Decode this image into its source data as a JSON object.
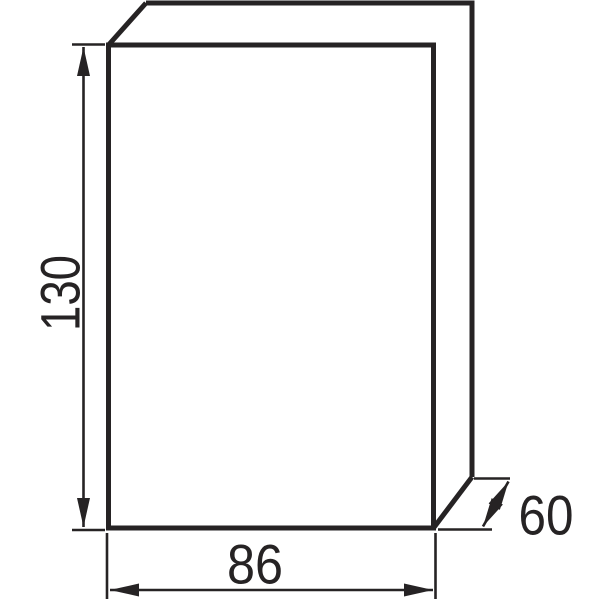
{
  "page": {
    "background_color": "#ffffff"
  },
  "drawing": {
    "line_color": "#262324",
    "dimensions": {
      "height": "130",
      "width": "86",
      "depth": "60"
    }
  }
}
